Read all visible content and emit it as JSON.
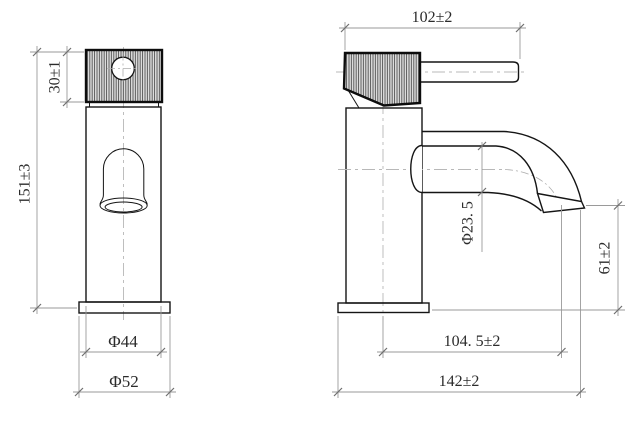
{
  "drawing": {
    "subject": "basin-faucet-two-view-dimension-drawing",
    "background": "#ffffff",
    "colors": {
      "object_line": "#151515",
      "dimension_line": "#9a9a9a",
      "center_line": "#b8b8b8",
      "text": "#2b2b2b"
    },
    "dimensions": {
      "handle_height": "30±1",
      "overall_height": "151±3",
      "body_diameter": "Φ44",
      "base_diameter": "Φ52",
      "handle_length": "102±2",
      "spout_tube_diameter": "Φ23. 5",
      "outlet_height": "61±2",
      "spout_reach": "104. 5±2",
      "overall_depth": "142±2"
    }
  }
}
